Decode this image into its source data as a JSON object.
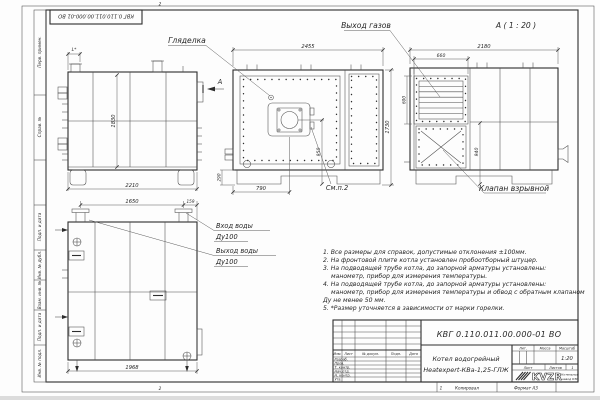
{
  "sheet": {
    "corner_designation": "КВГ 0.110.011.00.000-01 ВО",
    "fold_top": "2",
    "fold_bottom": "2",
    "fold_bottom2": "1",
    "margin_cells": [
      "Перв. примен.",
      "Справ. №",
      "Подп. и дата",
      "Инв. № дубл.",
      "Взам. инв. №",
      "Подп. и дата",
      "Инв. № подл."
    ],
    "copied": "Копировал",
    "format": "Формат А3"
  },
  "views": {
    "side": {
      "dim_l": "L*",
      "dim_height": "1830",
      "dim_width": "2210",
      "section": "А"
    },
    "front": {
      "dim_width": "2455",
      "dim_total_h": "1730",
      "dim_burner_h": "950",
      "dim_base_h": "290",
      "dim_burner_x": "790",
      "sight": "Гляделка",
      "see_note": "См.п.2"
    },
    "rear": {
      "title": "А ( 1 : 20 )",
      "dim_width": "2180",
      "dim_gas_w": "660",
      "dim_gas_h": "600",
      "dim_valve_h": "940",
      "gas_label": "Выход газов",
      "valve_label": "Клапан взрывной"
    },
    "back": {
      "dim_left": "1650",
      "dim_right": "159",
      "dim_width": "1968",
      "inlet": "Вход воды",
      "inlet_dn": "Ду100",
      "outlet": "Выход воды",
      "outlet_dn": "Ду100"
    }
  },
  "notes": {
    "lines": [
      "1. Все размеры для справок, допустимые отклонения ±100мм.",
      "2. На фронтовой плите котла установлен пробоотборный штуцер.",
      "3. На подводящей трубе котла, до запорной арматуры установлены:",
      "манометр, прибор для измерения температуры.",
      "4. На подводящей трубе котла, до запорной арматуры установлены:",
      "манометр, прибор для измерения температуры и обвод с обратным клапаном",
      "Ду не менее 50 мм.",
      "5. *Размер уточняется в зависимости от марки горелки."
    ]
  },
  "title_block": {
    "designation": "КВГ 0.110.011.00.000-01 ВО",
    "product1": "Котел водогрейный",
    "product2": "Heatexpert-КВа-1,25-ГЛЖ",
    "h_izm": "Изм.",
    "h_list": "Лист",
    "h_doc": "№ докум.",
    "h_sign": "Подп.",
    "h_date": "Дата",
    "r1": "Разраб.",
    "r2": "Пров.",
    "r3": "Т. контр.",
    "r4": "Нач.отд.",
    "r5": "Н. контр.",
    "r6": "Утв.",
    "lit": "Лит.",
    "mass": "Масса",
    "scale_h": "Масштаб",
    "scale": "1:20",
    "sheet_h": "Лист",
    "sheets_h": "Листов",
    "sheets_n": "1",
    "logo": "KVZR",
    "org1": "Котельный",
    "org2": "завод КЗР"
  }
}
